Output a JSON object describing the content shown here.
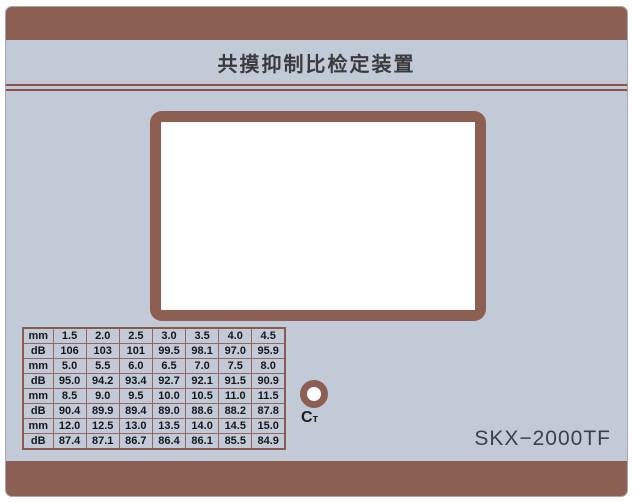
{
  "panel": {
    "title": "共摸抑制比检定装置",
    "model": "SKX−2000TF",
    "colors": {
      "brown": "#8d5e52",
      "panel_bg": "#c3cad7",
      "separator": "#8a5247",
      "table_border": "#96685c",
      "screen_bg": "#ffffff",
      "text_dark": "#17171a"
    }
  },
  "indicator": {
    "label_main": "C",
    "label_sub": "т"
  },
  "table": {
    "rows": [
      {
        "label": "mm",
        "values": [
          "1.5",
          "2.0",
          "2.5",
          "3.0",
          "3.5",
          "4.0",
          "4.5"
        ]
      },
      {
        "label": "dB",
        "values": [
          "106",
          "103",
          "101",
          "99.5",
          "98.1",
          "97.0",
          "95.9"
        ]
      },
      {
        "label": "mm",
        "values": [
          "5.0",
          "5.5",
          "6.0",
          "6.5",
          "7.0",
          "7.5",
          "8.0"
        ]
      },
      {
        "label": "dB",
        "values": [
          "95.0",
          "94.2",
          "93.4",
          "92.7",
          "92.1",
          "91.5",
          "90.9"
        ]
      },
      {
        "label": "mm",
        "values": [
          "8.5",
          "9.0",
          "9.5",
          "10.0",
          "10.5",
          "11.0",
          "11.5"
        ]
      },
      {
        "label": "dB",
        "values": [
          "90.4",
          "89.9",
          "89.4",
          "89.0",
          "88.6",
          "88.2",
          "87.8"
        ]
      },
      {
        "label": "mm",
        "values": [
          "12.0",
          "12.5",
          "13.0",
          "13.5",
          "14.0",
          "14.5",
          "15.0"
        ]
      },
      {
        "label": "dB",
        "values": [
          "87.4",
          "87.1",
          "86.7",
          "86.4",
          "86.1",
          "85.5",
          "84.9"
        ]
      }
    ]
  }
}
